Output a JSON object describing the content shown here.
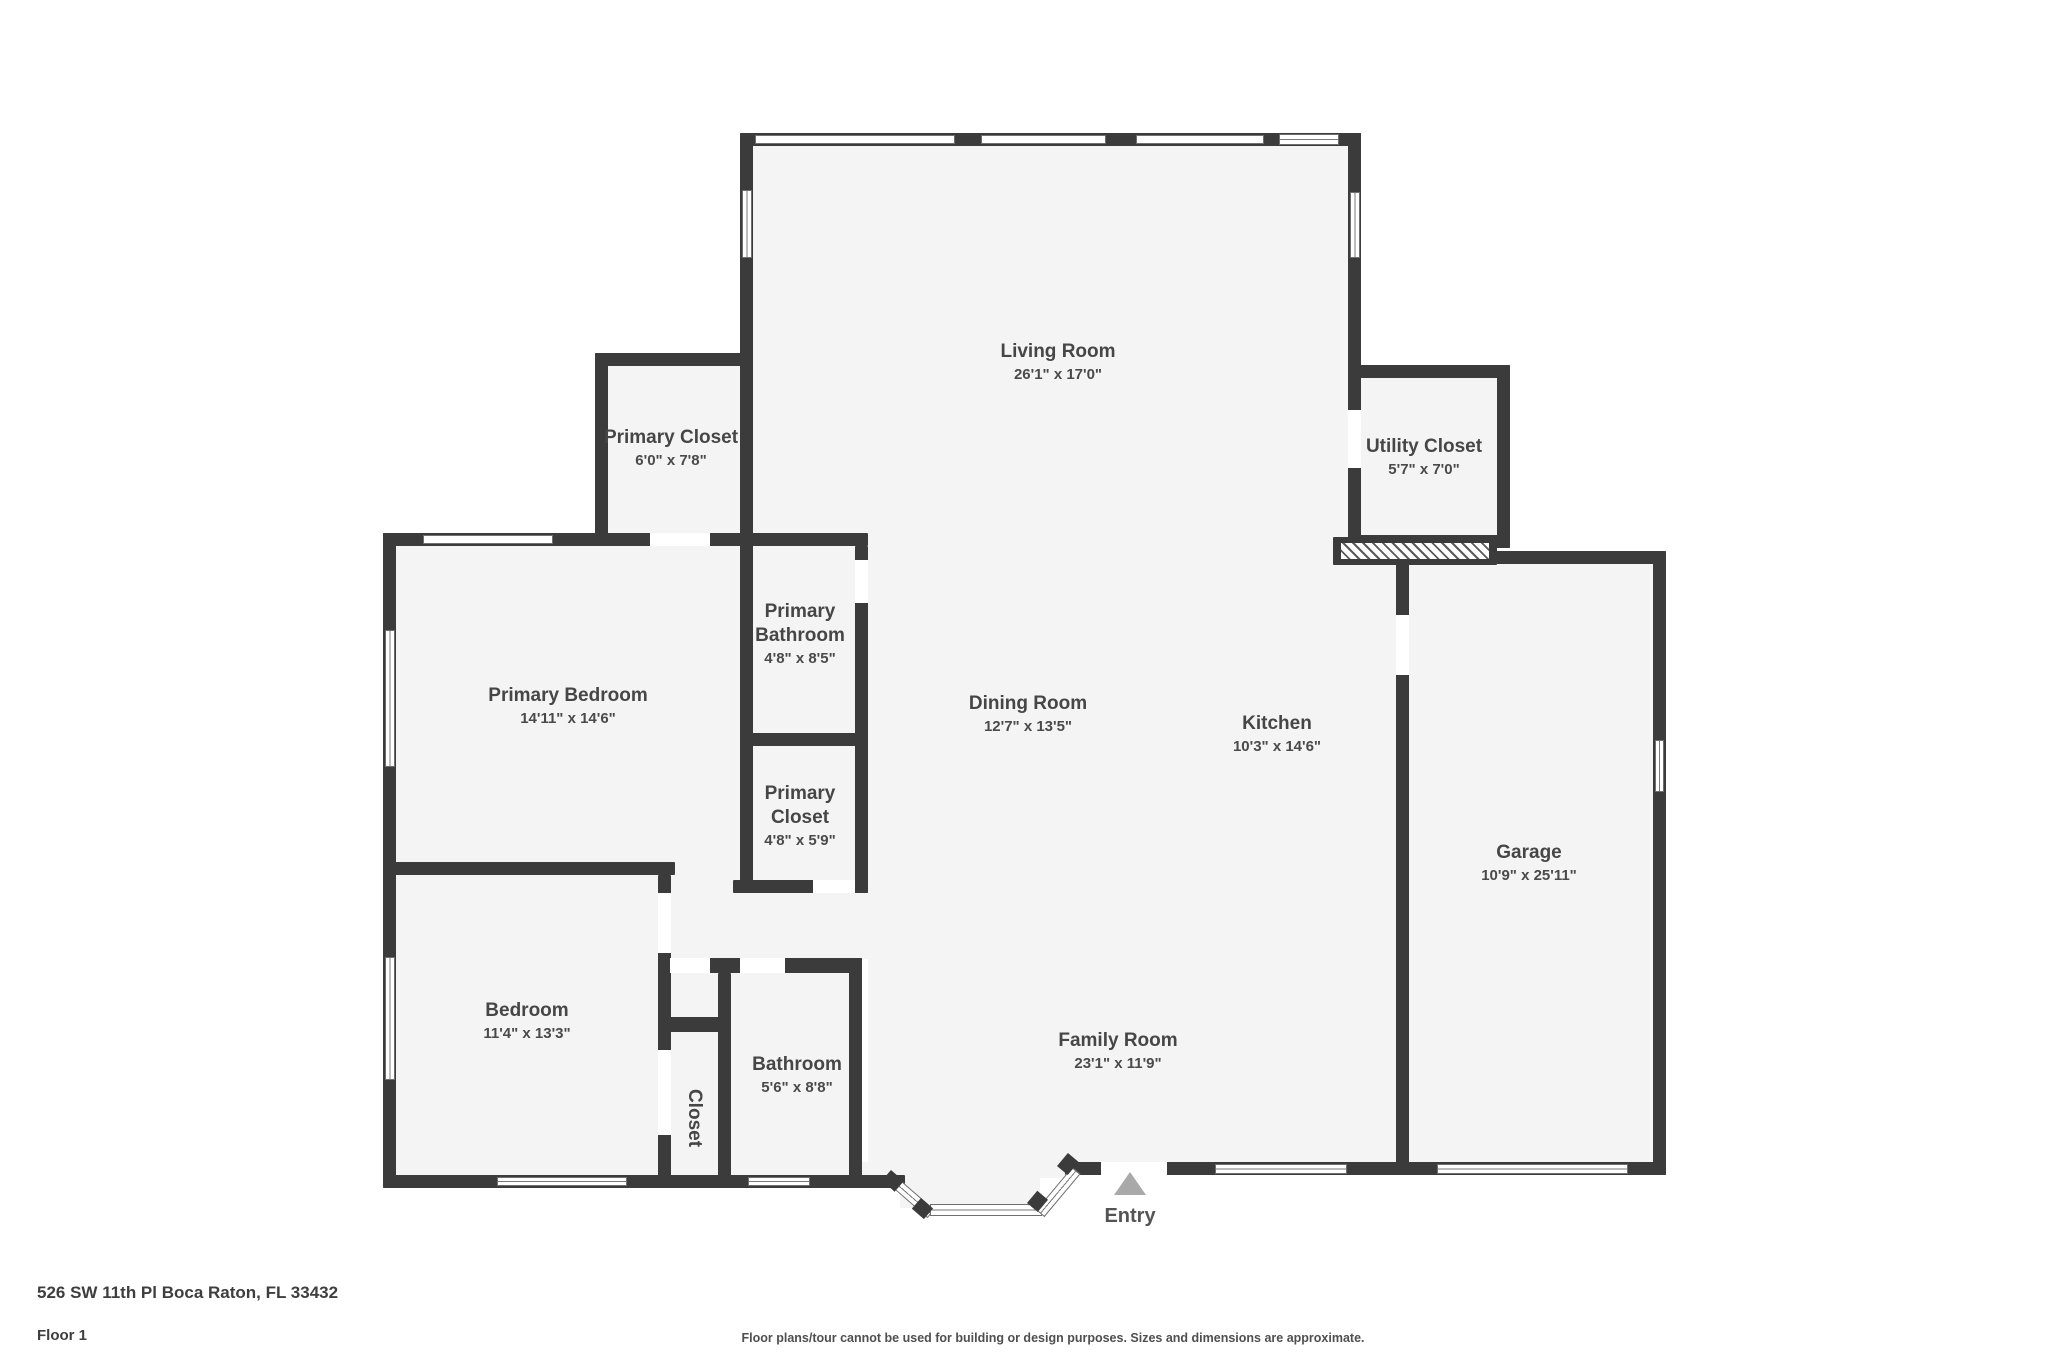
{
  "meta": {
    "title": "Floor plan - Floor 1"
  },
  "colors": {
    "wall": "#3b3b3b",
    "floor_fill": "#f4f4f5",
    "label_text": "#464646",
    "entry_arrow": "#a9a9a9",
    "background": "#ffffff"
  },
  "rooms": [
    {
      "id": "living-room",
      "name": "Living Room",
      "dims": "26'1\" x 17'0\"",
      "x": 1058,
      "y": 340,
      "wrap": 0,
      "rotate": 0
    },
    {
      "id": "primary-closet-top",
      "name": "Primary Closet",
      "dims": "6'0\" x 7'8\"",
      "x": 671,
      "y": 426,
      "wrap": 0,
      "rotate": 0
    },
    {
      "id": "utility-closet",
      "name": "Utility Closet",
      "dims": "5'7\" x 7'0\"",
      "x": 1424,
      "y": 435,
      "wrap": 0,
      "rotate": 0
    },
    {
      "id": "primary-bedroom",
      "name": "Primary Bedroom",
      "dims": "14'11\" x 14'6\"",
      "x": 568,
      "y": 684,
      "wrap": 0,
      "rotate": 0
    },
    {
      "id": "primary-bathroom",
      "name": "Primary Bathroom",
      "dims": "4'8\" x 8'5\"",
      "x": 800,
      "y": 600,
      "wrap": 120,
      "rotate": 0
    },
    {
      "id": "primary-closet",
      "name": "Primary Closet",
      "dims": "4'8\" x 5'9\"",
      "x": 800,
      "y": 782,
      "wrap": 110,
      "rotate": 0
    },
    {
      "id": "dining-room",
      "name": "Dining Room",
      "dims": "12'7\" x 13'5\"",
      "x": 1028,
      "y": 692,
      "wrap": 0,
      "rotate": 0
    },
    {
      "id": "kitchen",
      "name": "Kitchen",
      "dims": "10'3\" x 14'6\"",
      "x": 1277,
      "y": 712,
      "wrap": 0,
      "rotate": 0
    },
    {
      "id": "garage",
      "name": "Garage",
      "dims": "10'9\" x 25'11\"",
      "x": 1529,
      "y": 841,
      "wrap": 0,
      "rotate": 0
    },
    {
      "id": "bedroom",
      "name": "Bedroom",
      "dims": "11'4\" x 13'3\"",
      "x": 527,
      "y": 999,
      "wrap": 0,
      "rotate": 0
    },
    {
      "id": "closet",
      "name": "Closet",
      "dims": "",
      "x": 694,
      "y": 1118,
      "wrap": 0,
      "rotate": 90
    },
    {
      "id": "bathroom",
      "name": "Bathroom",
      "dims": "5'6\" x 8'8\"",
      "x": 797,
      "y": 1053,
      "wrap": 0,
      "rotate": 0
    },
    {
      "id": "family-room",
      "name": "Family Room",
      "dims": "23'1\" x 11'9\"",
      "x": 1118,
      "y": 1029,
      "wrap": 0,
      "rotate": 0
    }
  ],
  "entry": {
    "label": "Entry",
    "x": 1130,
    "arrow_y": 1172,
    "label_y": 1205
  },
  "footer": {
    "address": "526 SW 11th Pl Boca Raton, FL 33432",
    "floor_label": "Floor 1",
    "disclaimer": "Floor plans/tour cannot be used for building or design purposes. Sizes and dimensions are approximate."
  }
}
